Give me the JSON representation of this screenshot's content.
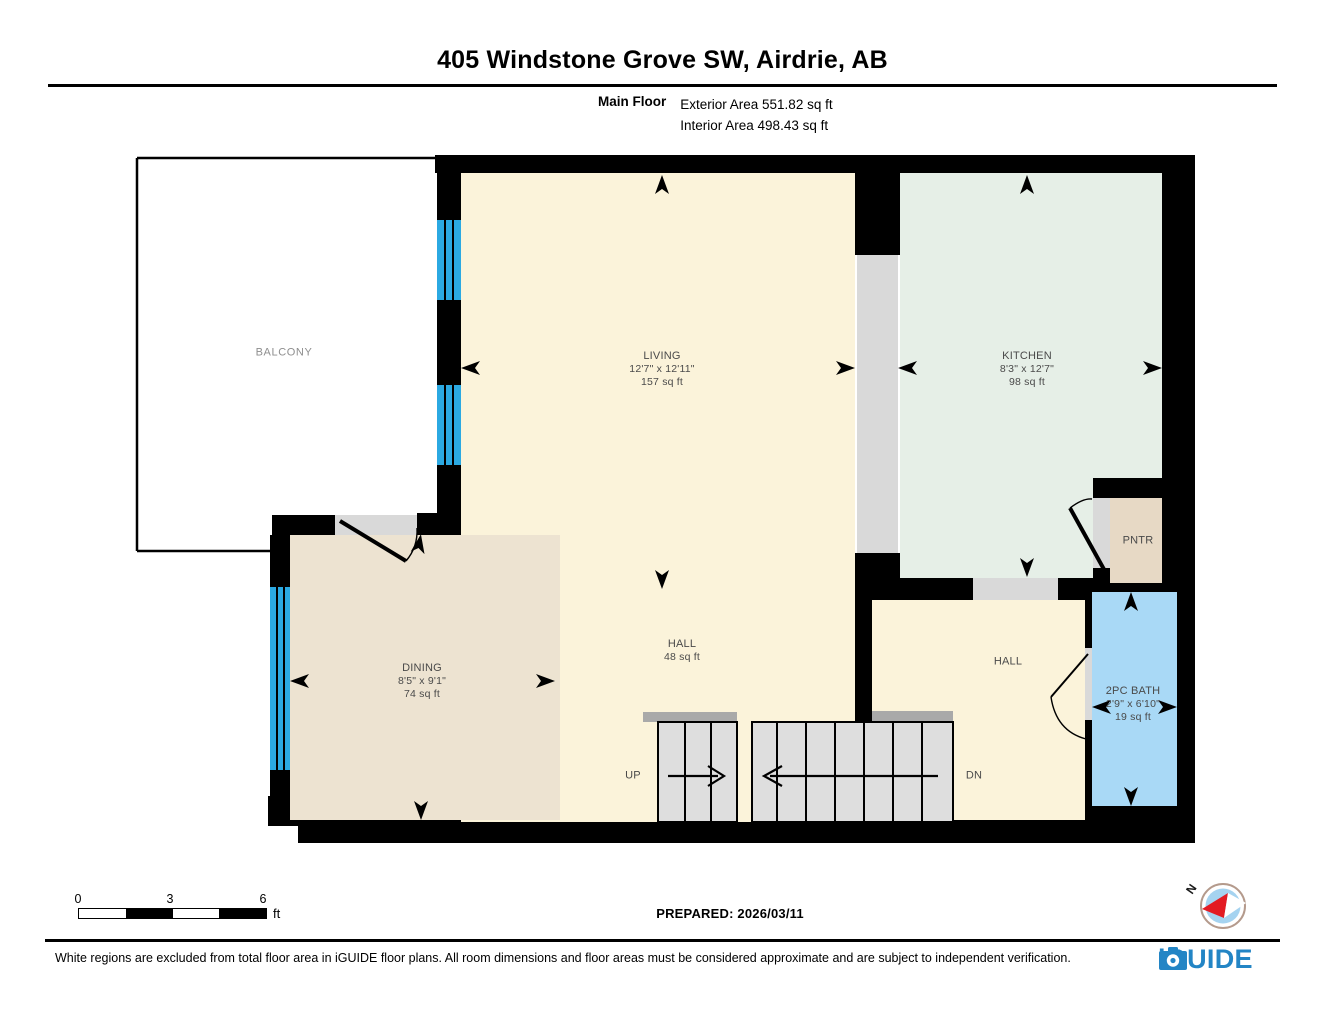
{
  "header": {
    "title": "405 Windstone Grove SW, Airdrie, AB",
    "floor_label": "Main Floor",
    "exterior_area": "Exterior Area 551.82 sq ft",
    "interior_area": "Interior Area 498.43 sq ft"
  },
  "rooms": {
    "balcony": {
      "name": "BALCONY"
    },
    "living": {
      "name": "LIVING",
      "dims": "12'7\" x 12'11\"",
      "area": "157 sq ft"
    },
    "kitchen": {
      "name": "KITCHEN",
      "dims": "8'3\" x 12'7\"",
      "area": "98 sq ft"
    },
    "dining": {
      "name": "DINING",
      "dims": "8'5\" x 9'1\"",
      "area": "74 sq ft"
    },
    "hall_main": {
      "name": "HALL",
      "area": "48 sq ft"
    },
    "hall_right": {
      "name": "HALL"
    },
    "bath": {
      "name": "2PC BATH",
      "dims": "2'9\" x 6'10\"",
      "area": "19 sq ft"
    },
    "pantry": {
      "name": "PNTR"
    }
  },
  "stairs": {
    "up": "UP",
    "down": "DN"
  },
  "scale_bar": {
    "ticks": [
      "0",
      "3",
      "6"
    ],
    "unit": "ft"
  },
  "compass": {
    "north_label": "N"
  },
  "footer": {
    "prepared": "PREPARED: 2026/03/11",
    "disclaimer": "White regions are excluded from total floor area in iGUIDE floor plans. All room dimensions and floor areas must be considered approximate and are subject to independent verification.",
    "brand": "iGUIDE"
  },
  "colors": {
    "wall": "#000000",
    "living": "#FBF3DA",
    "dining": "#EDE3D1",
    "kitchen": "#E6EFE7",
    "bath": "#A9D9F6",
    "pantry": "#E7D9C5",
    "window": "#2BA9E2",
    "stair": "#DEDEDE",
    "rail": "#A9A9A9",
    "threshold": "#D9D9D9",
    "brand": "#2385C5",
    "compass-red": "#E31B23",
    "compass-blue": "#A5D3F0"
  }
}
